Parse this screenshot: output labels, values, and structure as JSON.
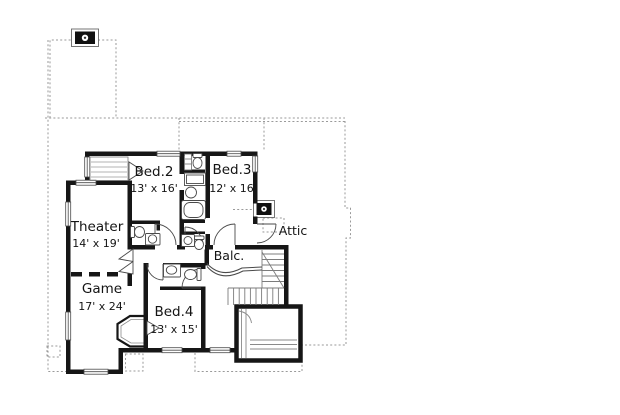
{
  "drawing": {
    "type": "second-floor plan",
    "rooms": [
      {
        "id": "bed2",
        "name": "Bed.2",
        "dims": "13' x 16'"
      },
      {
        "id": "bed3",
        "name": "Bed.3",
        "dims": "12' x 16'"
      },
      {
        "id": "theater",
        "name": "Theater",
        "dims": "14' x 19'"
      },
      {
        "id": "game",
        "name": "Game",
        "dims": "17' x 24'"
      },
      {
        "id": "bed4",
        "name": "Bed.4",
        "dims": "13' x 15'"
      },
      {
        "id": "balcony",
        "name": "Balc.",
        "dims": ""
      },
      {
        "id": "attic",
        "name": "Attic",
        "dims": ""
      }
    ],
    "symbols": [
      "wall",
      "window",
      "door-swing",
      "double-door",
      "stairs",
      "railing-curve",
      "chimney",
      "toilet",
      "sink",
      "bathtub",
      "shower",
      "closet-shelves",
      "roof-outline-dashed"
    ],
    "colors": {
      "wall": "#161616",
      "fixture_line": "#4a4a4a",
      "dashed_outline": "#9a9a9a",
      "background": "#ffffff"
    }
  }
}
